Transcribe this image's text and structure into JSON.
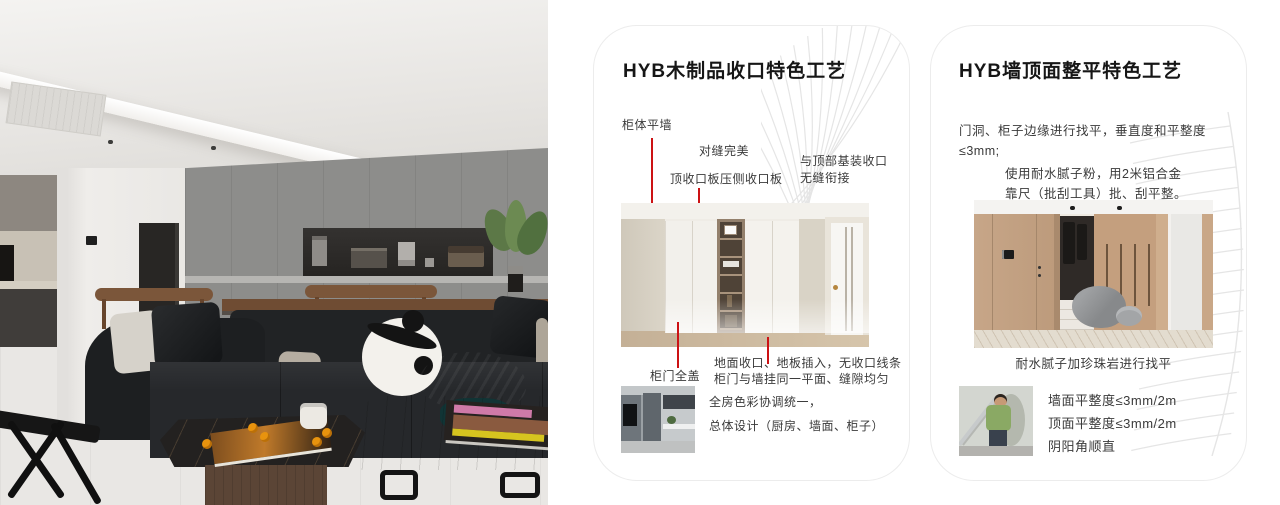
{
  "colors": {
    "accent_red": "#cc1214",
    "card_border": "#ececec",
    "pattern_line": "#e5e5e5",
    "page_bg": "#ffffff"
  },
  "cards": [
    {
      "title": "HYB木制品收口特色工艺",
      "callouts": {
        "cabinet_flush_wall": "柜体平墙",
        "seam_perfect": "对缝完美",
        "top_board_press": "顶收口板压侧收口板",
        "top_joint_line1": "与顶部基装收口",
        "top_joint_line2": "无缝衔接",
        "door_full_cover": "柜门全盖",
        "floor_joint_line1": "地面收口、地板插入，无收口线条",
        "floor_joint_line2": "柜门与墙挂同一平面、缝隙均匀",
        "color_unify_line1": "全房色彩协调统一，",
        "color_unify_line2": "总体设计（厨房、墙面、柜子）"
      }
    },
    {
      "title": "HYB墙顶面整平特色工艺",
      "paragraphs": {
        "leveling": "门洞、柜子边缘进行找平，垂直度和平整度≤3mm;",
        "putty": "使用耐水腻子粉，用2米铝合金靠尺（批刮工具）批、刮平整。",
        "caption": "耐水腻子加珍珠岩进行找平",
        "spec_wall": "墙面平整度≤3mm/2m",
        "spec_ceiling": "顶面平整度≤3mm/2m",
        "spec_corner": "阴阳角顺直"
      }
    }
  ]
}
